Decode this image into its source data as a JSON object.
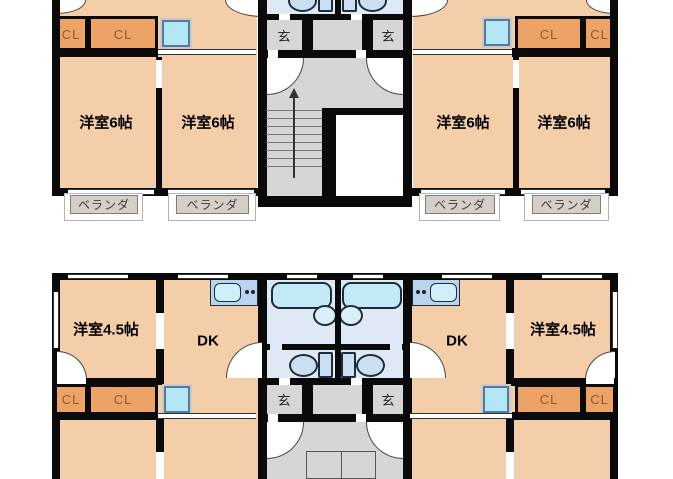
{
  "plan": {
    "upper": {
      "rooms": [
        "洋室6帖",
        "洋室6帖",
        "洋室6帖",
        "洋室6帖"
      ],
      "closets": [
        "CL",
        "CL",
        "CL",
        "CL"
      ],
      "entrances": [
        "玄",
        "玄"
      ],
      "verandas": [
        "ベランダ",
        "ベランダ",
        "ベランダ",
        "ベランダ"
      ]
    },
    "lower": {
      "rooms": [
        "洋室4.5帖",
        "DK",
        "DK",
        "洋室4.5帖"
      ],
      "closets": [
        "CL",
        "CL",
        "CL",
        "CL"
      ],
      "entrances": [
        "玄",
        "玄"
      ]
    },
    "colors": {
      "wall": "#0a0a0a",
      "room": "#F4CDA9",
      "closet": "#EDA266",
      "floor_gray": "#D6D6D6",
      "bath": "#DEE9F5",
      "fixture": "#C2E9F6",
      "counter": "#B9D4EE",
      "veranda": "#D6CFC7",
      "washer": "#B5E6F6"
    }
  }
}
